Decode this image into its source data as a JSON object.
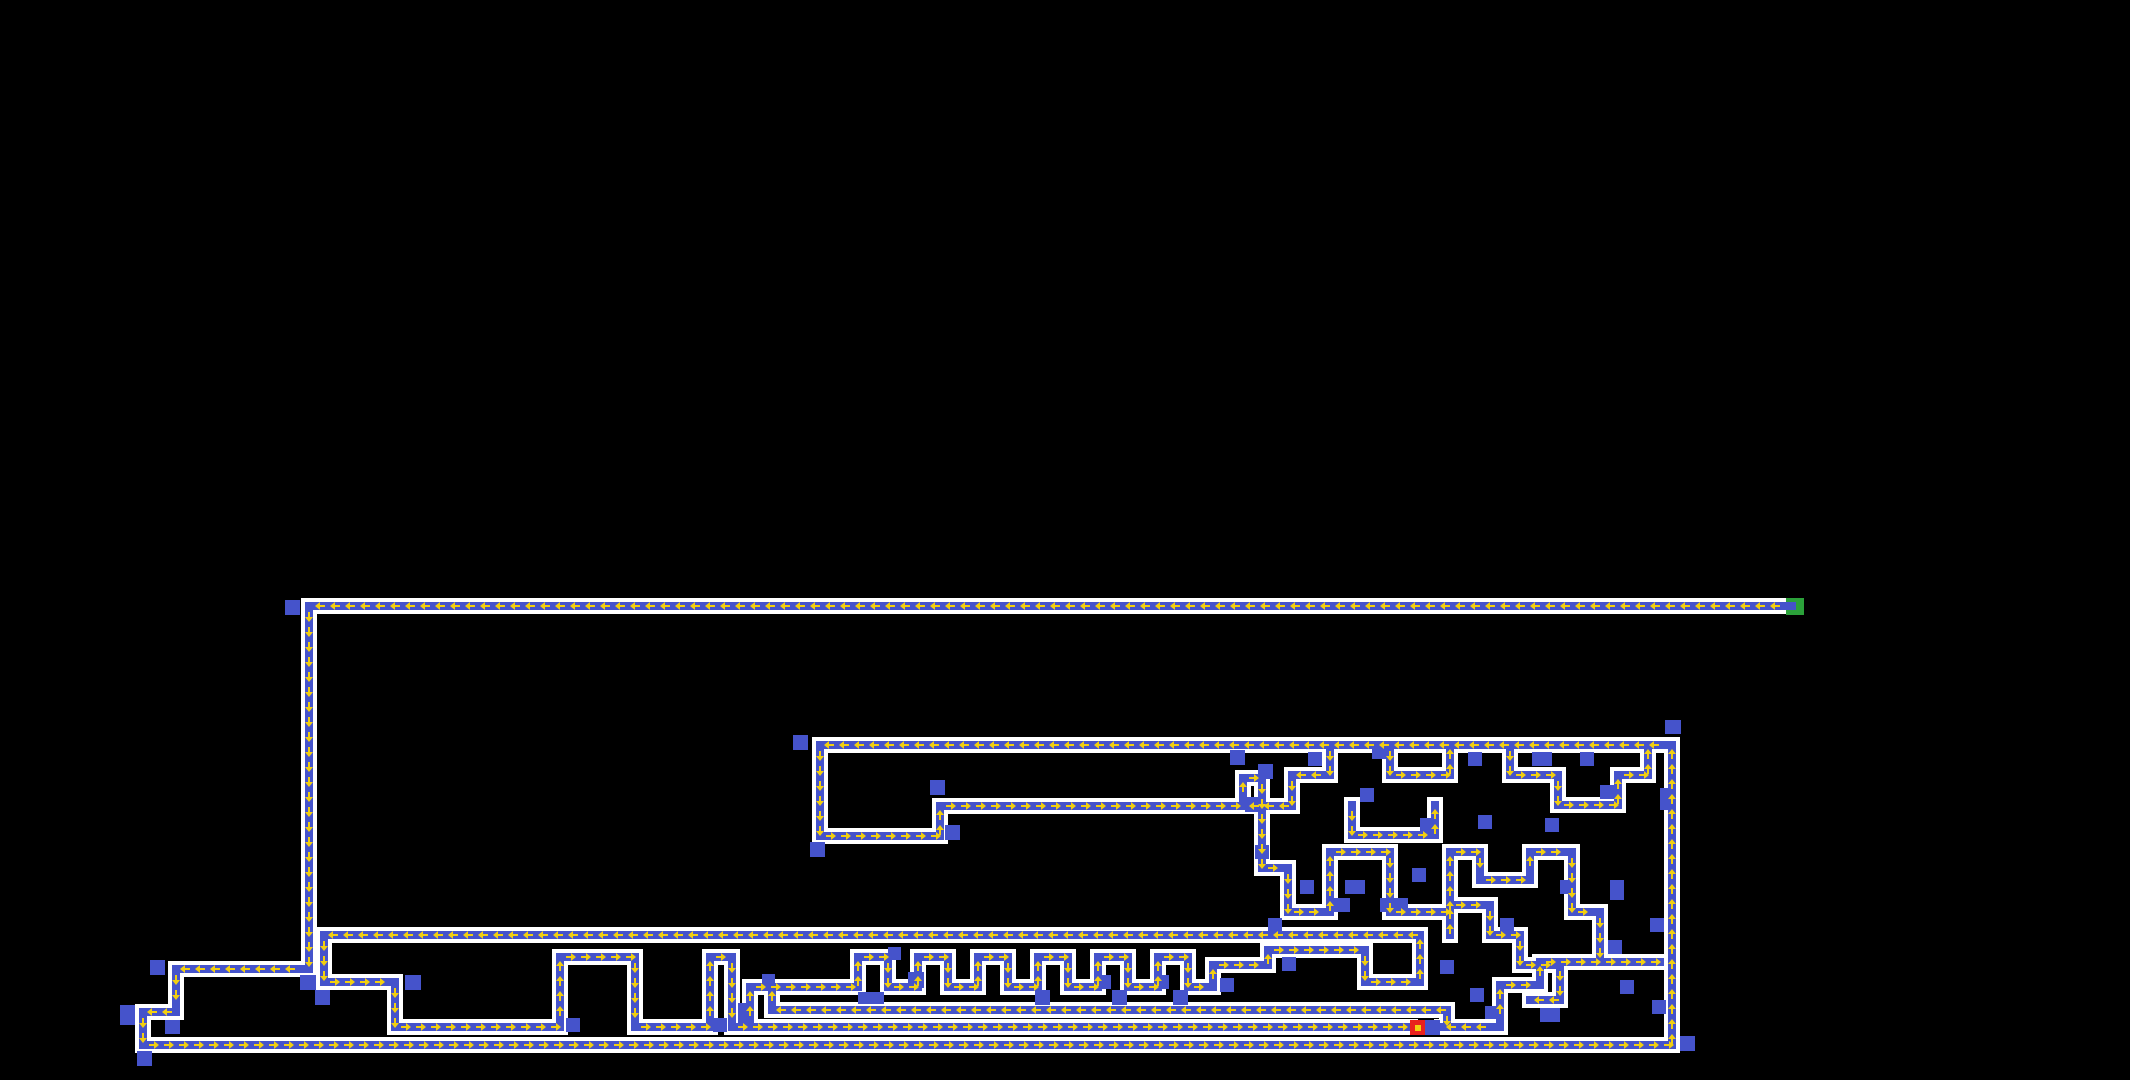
{
  "scene": {
    "width": 2130,
    "height": 1080,
    "background": "#000000"
  },
  "style": {
    "wall_color": "#ffffff",
    "path_color": "#4553cb",
    "block_color": "#4553cb",
    "arrow_color": "#f2cf10",
    "wall_thickness": 16,
    "path_thickness": 8,
    "arrow_spacing": 15
  },
  "markers": {
    "start": {
      "name": "entrance",
      "x": 1786,
      "y": 598,
      "w": 18,
      "h": 17,
      "color": "#2ba13a"
    },
    "goal": {
      "name": "goal",
      "x": 1410,
      "y": 1020,
      "w": 15,
      "h": 15,
      "color": "#e9211d"
    },
    "agent": {
      "name": "agent",
      "x": 1415,
      "y": 1025,
      "w": 6,
      "h": 6,
      "color": "#f2cf10"
    }
  },
  "path_segments": [
    [
      311,
      606,
      1792,
      606,
      "left"
    ],
    [
      309,
      606,
      309,
      969,
      "down"
    ],
    [
      176,
      969,
      309,
      969,
      "left"
    ],
    [
      176,
      969,
      176,
      1012,
      "down"
    ],
    [
      143,
      1012,
      176,
      1012,
      "left"
    ],
    [
      143,
      1012,
      143,
      1045,
      "down"
    ],
    [
      143,
      1045,
      1672,
      1045,
      "right"
    ],
    [
      1672,
      745,
      1672,
      1045,
      "up"
    ],
    [
      820,
      745,
      1672,
      745,
      "left"
    ],
    [
      820,
      745,
      820,
      836,
      "down"
    ],
    [
      820,
      836,
      940,
      836,
      "right"
    ],
    [
      940,
      806,
      940,
      836,
      "up"
    ],
    [
      940,
      806,
      1243,
      806,
      "right"
    ],
    [
      1243,
      778,
      1243,
      806,
      "up"
    ],
    [
      1243,
      778,
      1262,
      778,
      "right"
    ],
    [
      1262,
      778,
      1262,
      868,
      "down"
    ],
    [
      1262,
      868,
      1288,
      868,
      "right"
    ],
    [
      1288,
      868,
      1288,
      912,
      "down"
    ],
    [
      324,
      935,
      1420,
      935,
      "left"
    ],
    [
      324,
      935,
      324,
      982,
      "down"
    ],
    [
      324,
      982,
      395,
      982,
      "right"
    ],
    [
      395,
      982,
      395,
      1027,
      "down"
    ],
    [
      395,
      1027,
      560,
      1027,
      "right"
    ],
    [
      560,
      957,
      560,
      1027,
      "up"
    ],
    [
      560,
      957,
      635,
      957,
      "right"
    ],
    [
      635,
      957,
      635,
      1027,
      "down"
    ],
    [
      635,
      1027,
      710,
      1027,
      "right"
    ],
    [
      710,
      957,
      710,
      1027,
      "up"
    ],
    [
      710,
      957,
      732,
      957,
      "right"
    ],
    [
      732,
      957,
      732,
      1027,
      "down"
    ],
    [
      732,
      1027,
      1410,
      1027,
      "right"
    ],
    [
      750,
      987,
      750,
      1027,
      "up"
    ],
    [
      750,
      987,
      858,
      987,
      "right"
    ],
    [
      858,
      957,
      858,
      987,
      "up"
    ],
    [
      858,
      957,
      888,
      957,
      "right"
    ],
    [
      888,
      957,
      888,
      987,
      "down"
    ],
    [
      888,
      987,
      918,
      987,
      "right"
    ],
    [
      918,
      957,
      918,
      987,
      "up"
    ],
    [
      918,
      957,
      948,
      957,
      "right"
    ],
    [
      948,
      957,
      948,
      987,
      "down"
    ],
    [
      948,
      987,
      978,
      987,
      "right"
    ],
    [
      978,
      957,
      978,
      987,
      "up"
    ],
    [
      978,
      957,
      1008,
      957,
      "right"
    ],
    [
      1008,
      957,
      1008,
      987,
      "down"
    ],
    [
      1008,
      987,
      1038,
      987,
      "right"
    ],
    [
      1038,
      957,
      1038,
      987,
      "up"
    ],
    [
      1038,
      957,
      1068,
      957,
      "right"
    ],
    [
      1068,
      957,
      1068,
      987,
      "down"
    ],
    [
      1068,
      987,
      1098,
      987,
      "right"
    ],
    [
      1098,
      957,
      1098,
      987,
      "up"
    ],
    [
      1098,
      957,
      1128,
      957,
      "right"
    ],
    [
      1128,
      957,
      1128,
      987,
      "down"
    ],
    [
      1128,
      987,
      1158,
      987,
      "right"
    ],
    [
      1158,
      957,
      1158,
      987,
      "up"
    ],
    [
      1158,
      957,
      1188,
      957,
      "right"
    ],
    [
      1188,
      957,
      1188,
      987,
      "down"
    ],
    [
      1188,
      987,
      1213,
      987,
      "right"
    ],
    [
      1213,
      965,
      1213,
      987,
      "up"
    ],
    [
      1213,
      965,
      1268,
      965,
      "right"
    ],
    [
      1268,
      950,
      1268,
      965,
      "up"
    ],
    [
      1268,
      950,
      1365,
      950,
      "right"
    ],
    [
      1365,
      950,
      1365,
      982,
      "down"
    ],
    [
      1365,
      982,
      1420,
      982,
      "right"
    ],
    [
      1420,
      935,
      1420,
      982,
      "up"
    ],
    [
      772,
      1010,
      1447,
      1010,
      "left"
    ],
    [
      772,
      987,
      772,
      1010,
      "up"
    ],
    [
      1447,
      1010,
      1447,
      1027,
      "down"
    ],
    [
      1442,
      1027,
      1500,
      1027,
      "left"
    ],
    [
      1500,
      985,
      1500,
      1027,
      "up"
    ],
    [
      1500,
      985,
      1540,
      985,
      "right"
    ],
    [
      1540,
      962,
      1540,
      985,
      "up"
    ],
    [
      1540,
      962,
      1600,
      962,
      "right"
    ],
    [
      1330,
      745,
      1330,
      775,
      "down"
    ],
    [
      1292,
      775,
      1330,
      775,
      "left"
    ],
    [
      1292,
      775,
      1292,
      806,
      "down"
    ],
    [
      1245,
      806,
      1292,
      806,
      "left"
    ],
    [
      1390,
      745,
      1390,
      775,
      "down"
    ],
    [
      1390,
      775,
      1450,
      775,
      "right"
    ],
    [
      1450,
      745,
      1450,
      775,
      "up"
    ],
    [
      1510,
      745,
      1510,
      775,
      "down"
    ],
    [
      1510,
      775,
      1558,
      775,
      "right"
    ],
    [
      1558,
      775,
      1558,
      805,
      "down"
    ],
    [
      1558,
      805,
      1618,
      805,
      "right"
    ],
    [
      1618,
      775,
      1618,
      805,
      "up"
    ],
    [
      1618,
      775,
      1648,
      775,
      "right"
    ],
    [
      1648,
      745,
      1648,
      775,
      "up"
    ],
    [
      1352,
      805,
      1352,
      835,
      "down"
    ],
    [
      1352,
      835,
      1435,
      835,
      "right"
    ],
    [
      1435,
      805,
      1435,
      835,
      "up"
    ],
    [
      1288,
      912,
      1330,
      912,
      "right"
    ],
    [
      1330,
      852,
      1330,
      912,
      "up"
    ],
    [
      1330,
      852,
      1390,
      852,
      "right"
    ],
    [
      1390,
      852,
      1390,
      912,
      "down"
    ],
    [
      1390,
      912,
      1450,
      912,
      "right"
    ],
    [
      1450,
      852,
      1450,
      912,
      "up"
    ],
    [
      1450,
      852,
      1480,
      852,
      "right"
    ],
    [
      1480,
      852,
      1480,
      880,
      "down"
    ],
    [
      1480,
      880,
      1530,
      880,
      "right"
    ],
    [
      1530,
      852,
      1530,
      880,
      "up"
    ],
    [
      1530,
      852,
      1572,
      852,
      "right"
    ],
    [
      1572,
      852,
      1572,
      912,
      "down"
    ],
    [
      1572,
      912,
      1600,
      912,
      "right"
    ],
    [
      1600,
      912,
      1600,
      962,
      "down"
    ],
    [
      1600,
      962,
      1660,
      962,
      "right"
    ],
    [
      1450,
      905,
      1450,
      935,
      "up"
    ],
    [
      1450,
      905,
      1490,
      905,
      "right"
    ],
    [
      1490,
      905,
      1490,
      935,
      "down"
    ],
    [
      1490,
      935,
      1520,
      935,
      "right"
    ],
    [
      1520,
      935,
      1520,
      965,
      "down"
    ],
    [
      1520,
      965,
      1560,
      965,
      "right"
    ],
    [
      1560,
      965,
      1560,
      1000,
      "down"
    ],
    [
      1530,
      1000,
      1560,
      1000,
      "left"
    ]
  ],
  "blocks": [
    [
      285,
      600,
      15,
      15
    ],
    [
      793,
      735,
      15,
      15
    ],
    [
      930,
      780,
      15,
      15
    ],
    [
      945,
      825,
      15,
      15
    ],
    [
      810,
      842,
      15,
      15
    ],
    [
      150,
      960,
      15,
      15
    ],
    [
      300,
      975,
      16,
      15
    ],
    [
      405,
      975,
      16,
      15
    ],
    [
      315,
      990,
      15,
      15
    ],
    [
      120,
      1005,
      15,
      20
    ],
    [
      165,
      1020,
      15,
      14
    ],
    [
      137,
      1051,
      15,
      15
    ],
    [
      566,
      1018,
      14,
      14
    ],
    [
      713,
      1018,
      14,
      14
    ],
    [
      738,
      1003,
      11,
      24
    ],
    [
      762,
      974,
      13,
      13
    ],
    [
      888,
      947,
      13,
      13
    ],
    [
      908,
      972,
      16,
      16
    ],
    [
      858,
      992,
      26,
      12
    ],
    [
      1035,
      990,
      15,
      15
    ],
    [
      1097,
      975,
      14,
      14
    ],
    [
      1112,
      990,
      15,
      15
    ],
    [
      1155,
      975,
      14,
      14
    ],
    [
      1173,
      990,
      15,
      15
    ],
    [
      1220,
      978,
      14,
      14
    ],
    [
      1282,
      957,
      14,
      14
    ],
    [
      1230,
      750,
      15,
      15
    ],
    [
      1258,
      764,
      15,
      15
    ],
    [
      1245,
      797,
      15,
      15
    ],
    [
      1665,
      720,
      16,
      14
    ],
    [
      1680,
      1036,
      15,
      15
    ],
    [
      1425,
      1020,
      15,
      15
    ],
    [
      1485,
      1006,
      14,
      13
    ],
    [
      1308,
      752,
      14,
      14
    ],
    [
      1372,
      745,
      20,
      14
    ],
    [
      1360,
      788,
      14,
      14
    ],
    [
      1420,
      818,
      14,
      14
    ],
    [
      1468,
      752,
      14,
      14
    ],
    [
      1478,
      815,
      14,
      14
    ],
    [
      1532,
      752,
      20,
      14
    ],
    [
      1545,
      818,
      14,
      14
    ],
    [
      1580,
      752,
      14,
      14
    ],
    [
      1600,
      785,
      14,
      14
    ],
    [
      1660,
      788,
      14,
      22
    ],
    [
      1255,
      845,
      14,
      14
    ],
    [
      1300,
      880,
      14,
      14
    ],
    [
      1345,
      880,
      20,
      14
    ],
    [
      1412,
      868,
      14,
      14
    ],
    [
      1500,
      918,
      14,
      14
    ],
    [
      1330,
      898,
      20,
      14
    ],
    [
      1380,
      898,
      28,
      14
    ],
    [
      1560,
      880,
      14,
      14
    ],
    [
      1610,
      880,
      14,
      20
    ],
    [
      1650,
      918,
      14,
      14
    ],
    [
      1440,
      960,
      14,
      14
    ],
    [
      1470,
      988,
      14,
      14
    ],
    [
      1540,
      1008,
      20,
      14
    ],
    [
      1620,
      980,
      14,
      14
    ],
    [
      1652,
      1000,
      14,
      14
    ],
    [
      1608,
      940,
      14,
      14
    ],
    [
      1268,
      918,
      14,
      14
    ]
  ]
}
